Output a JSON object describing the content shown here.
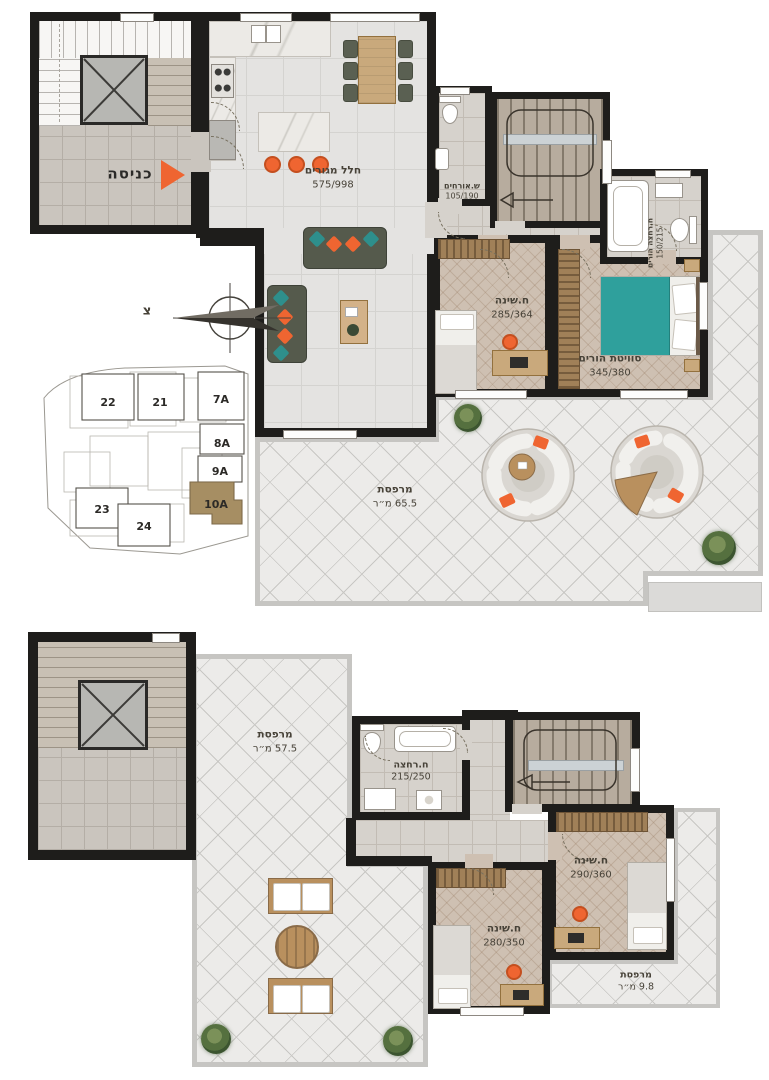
{
  "colors": {
    "wall": "#1e1d1b",
    "accent_orange": "#ef6531",
    "teal_bed": "#2fa09c",
    "site_highlight": "#a68e63"
  },
  "plan_upper": {
    "entrance": {
      "label": "כניסה"
    },
    "living": {
      "name": "חלל מגורים",
      "dims": "575/998"
    },
    "guest_wc": {
      "name": "ש.אורחים",
      "dims": "105/190"
    },
    "bedroom": {
      "name": "ח.שינה",
      "dims": "285/364"
    },
    "suite": {
      "name": "סוויטת הורים",
      "dims": "345/380"
    },
    "parents_bath": {
      "name": "ח.רחצה הורים",
      "dims": "150/215"
    },
    "balcony": {
      "name": "מרפסת",
      "area": "65.5 מ״ר"
    },
    "compass": {
      "north": "צ"
    }
  },
  "site_map": {
    "buildings": [
      {
        "label": "22"
      },
      {
        "label": "21"
      },
      {
        "label": "7A"
      },
      {
        "label": "8A"
      },
      {
        "label": "9A"
      },
      {
        "label": "10A",
        "highlighted": true
      },
      {
        "label": "23"
      },
      {
        "label": "24"
      }
    ]
  },
  "plan_lower": {
    "balcony": {
      "name": "מרפסת",
      "area": "57.5 מ״ר"
    },
    "bath": {
      "name": "ח.רחצה",
      "dims": "215/250"
    },
    "bedroom_a": {
      "name": "ח.שינה",
      "dims": "280/350"
    },
    "bedroom_b": {
      "name": "ח.שינה",
      "dims": "290/360"
    },
    "balcony_small": {
      "name": "מרפסת",
      "area": "9.8 מ״ר"
    }
  }
}
